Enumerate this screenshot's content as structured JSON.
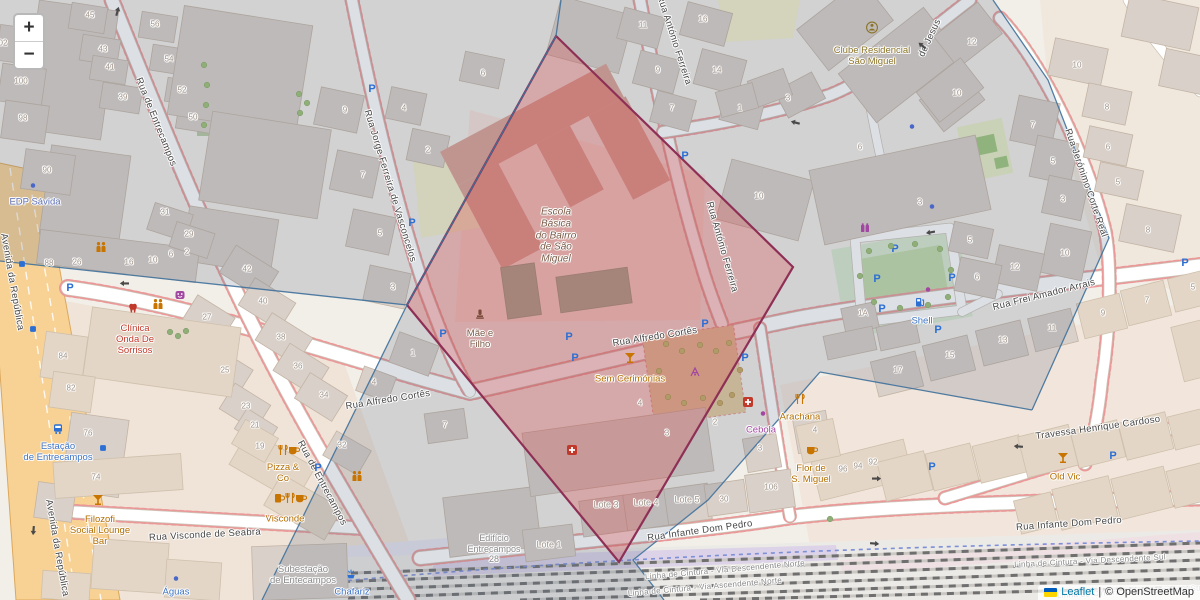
{
  "controls": {
    "zoom_in": "+",
    "zoom_out": "−"
  },
  "attribution": {
    "flag": "ukraine-flag",
    "leaflet": "Leaflet",
    "divider": "|",
    "osm": "© OpenStreetMap"
  },
  "palette": {
    "street_label": "#454545",
    "amenity": "#b36d00",
    "shop": "#a146a1",
    "transport": "#3d73c5",
    "office": "#5c6fb5",
    "health": "#c0392b",
    "school": "#7a5c49",
    "club": "#8a7326",
    "muted": "#8a8a8a",
    "housenumber": "#a09488",
    "rail_label": "#8c8c8c",
    "highlight_fill": "#dd4b4b",
    "highlight_stroke": "#8e2f55",
    "cell_lines": "#40719b"
  },
  "streets": [
    {
      "t": "Rua de Entrecampos",
      "x": 156,
      "y": 122,
      "rot": 68
    },
    {
      "t": "Rua de Entrecampos",
      "x": 322,
      "y": 483,
      "rot": 62
    },
    {
      "t": "Rua Jorge Ferreira de Vasconcelos",
      "x": 390,
      "y": 186,
      "rot": 73
    },
    {
      "t": "Rua António Ferreira",
      "x": 674,
      "y": 40,
      "rot": 72
    },
    {
      "t": "Rua António Ferreira",
      "x": 722,
      "y": 247,
      "rot": 74
    },
    {
      "t": "Rua Alfredo Cortês",
      "x": 388,
      "y": 400,
      "rot": -9
    },
    {
      "t": "Rua Alfredo Cortês",
      "x": 655,
      "y": 337,
      "rot": -9
    },
    {
      "t": "Rua Frei Amador Arrais",
      "x": 1044,
      "y": 295,
      "rot": -14
    },
    {
      "t": "Rua Jerónimo Corte Real",
      "x": 1086,
      "y": 183,
      "rot": 71
    },
    {
      "t": "Travessa Henrique Cardoso",
      "x": 1098,
      "y": 428,
      "rot": -8
    },
    {
      "t": "Rua Visconde de Seabra",
      "x": 205,
      "y": 535,
      "rot": -3
    },
    {
      "t": "Rua Infante Dom Pedro",
      "x": 700,
      "y": 531,
      "rot": -8
    },
    {
      "t": "Rua Infante Dom Pedro",
      "x": 1069,
      "y": 524,
      "rot": -4
    },
    {
      "t": "Avenida da República",
      "x": 12,
      "y": 282,
      "rot": 80
    },
    {
      "t": "Avenida da República",
      "x": 57,
      "y": 548,
      "rot": 80
    },
    {
      "t": "de Jesus",
      "x": 930,
      "y": 38,
      "rot": -65
    },
    {
      "t": "Linha de Cintura - Via Descendente Norte",
      "x": 725,
      "y": 570,
      "rot": -5,
      "sz": 8,
      "c": "rail_label"
    },
    {
      "t": "Linha de Cintura - Via Ascendente Norte",
      "x": 705,
      "y": 587,
      "rot": -5,
      "sz": 8,
      "c": "rail_label"
    },
    {
      "t": "Linha de Cintura - Via Descendente Sul",
      "x": 1090,
      "y": 561,
      "rot": -3,
      "sz": 8,
      "c": "rail_label"
    },
    {
      "t": "Linha de Cintura - Via Ascendente Sul",
      "x": 1130,
      "y": 592,
      "rot": -3,
      "sz": 8,
      "c": "rail_label"
    }
  ],
  "pois": [
    {
      "t": "EDP Sávida",
      "x": 35,
      "y": 202,
      "c": "office"
    },
    {
      "t": "Clínica\nOnda De\nSorrisos",
      "x": 135,
      "y": 340,
      "c": "health"
    },
    {
      "t": "Clube Residencial\nSão Miguel",
      "x": 872,
      "y": 56,
      "c": "club"
    },
    {
      "t": "Escola\nBásica\ndo Bairro\nde São\nMiguel",
      "x": 556,
      "y": 236,
      "c": "school",
      "it": 1,
      "sz": 10
    },
    {
      "t": "Mãe e\nFilho",
      "x": 480,
      "y": 339,
      "c": "school"
    },
    {
      "t": "Sem Cerimónias",
      "x": 630,
      "y": 379,
      "c": "amenity"
    },
    {
      "t": "Filozofi\nSocial Lounge\nBar",
      "x": 100,
      "y": 531,
      "c": "amenity"
    },
    {
      "t": "Pizza &\nCo",
      "x": 283,
      "y": 473,
      "c": "amenity"
    },
    {
      "t": "Visconde",
      "x": 285,
      "y": 519,
      "c": "amenity"
    },
    {
      "t": "Arachana",
      "x": 800,
      "y": 417,
      "c": "amenity"
    },
    {
      "t": "Cebola",
      "x": 761,
      "y": 430,
      "c": "shop"
    },
    {
      "t": "Flor de\nS. Miguel",
      "x": 811,
      "y": 474,
      "c": "amenity"
    },
    {
      "t": "Old Vic",
      "x": 1065,
      "y": 477,
      "c": "amenity"
    },
    {
      "t": "Shell",
      "x": 922,
      "y": 321,
      "c": "transport"
    },
    {
      "t": "Estação\nde Entrecampos",
      "x": 58,
      "y": 452,
      "c": "transport"
    },
    {
      "t": "Águas",
      "x": 176,
      "y": 592,
      "c": "transport"
    },
    {
      "t": "Chafariz",
      "x": 352,
      "y": 592,
      "c": "transport"
    },
    {
      "t": "Subestação\nde Entecampos",
      "x": 303,
      "y": 575,
      "c": "muted"
    },
    {
      "t": "Edifício\nEntrecampos\n28",
      "x": 494,
      "y": 549,
      "c": "muted",
      "sz": 9
    },
    {
      "t": "Lote 1",
      "x": 549,
      "y": 545,
      "c": "housenumber",
      "sz": 9
    },
    {
      "t": "Lote 3",
      "x": 606,
      "y": 505,
      "c": "housenumber",
      "sz": 9
    },
    {
      "t": "Lote 4",
      "x": 646,
      "y": 503,
      "c": "housenumber",
      "sz": 9
    },
    {
      "t": "Lote 5",
      "x": 687,
      "y": 500,
      "c": "housenumber",
      "sz": 9
    }
  ],
  "house_numbers": [
    {
      "t": "02",
      "x": 3,
      "y": 43
    },
    {
      "t": "100",
      "x": 21,
      "y": 81
    },
    {
      "t": "98",
      "x": 23,
      "y": 118
    },
    {
      "t": "90",
      "x": 47,
      "y": 170
    },
    {
      "t": "45",
      "x": 90,
      "y": 15
    },
    {
      "t": "43",
      "x": 103,
      "y": 49
    },
    {
      "t": "41",
      "x": 110,
      "y": 67
    },
    {
      "t": "39",
      "x": 123,
      "y": 97
    },
    {
      "t": "56",
      "x": 155,
      "y": 24
    },
    {
      "t": "54",
      "x": 169,
      "y": 59
    },
    {
      "t": "52",
      "x": 182,
      "y": 90
    },
    {
      "t": "50",
      "x": 193,
      "y": 117
    },
    {
      "t": "88",
      "x": 49,
      "y": 263
    },
    {
      "t": "26",
      "x": 77,
      "y": 262
    },
    {
      "t": "16",
      "x": 129,
      "y": 262
    },
    {
      "t": "10",
      "x": 153,
      "y": 260
    },
    {
      "t": "6",
      "x": 171,
      "y": 254
    },
    {
      "t": "2",
      "x": 187,
      "y": 252
    },
    {
      "t": "31",
      "x": 165,
      "y": 212
    },
    {
      "t": "29",
      "x": 189,
      "y": 234
    },
    {
      "t": "27",
      "x": 207,
      "y": 317
    },
    {
      "t": "25",
      "x": 225,
      "y": 370
    },
    {
      "t": "23",
      "x": 246,
      "y": 406
    },
    {
      "t": "21",
      "x": 255,
      "y": 425
    },
    {
      "t": "42",
      "x": 247,
      "y": 269
    },
    {
      "t": "40",
      "x": 263,
      "y": 301
    },
    {
      "t": "38",
      "x": 281,
      "y": 337
    },
    {
      "t": "36",
      "x": 298,
      "y": 366
    },
    {
      "t": "34",
      "x": 324,
      "y": 395
    },
    {
      "t": "84",
      "x": 63,
      "y": 356
    },
    {
      "t": "82",
      "x": 71,
      "y": 388
    },
    {
      "t": "76",
      "x": 88,
      "y": 433
    },
    {
      "t": "74",
      "x": 96,
      "y": 477
    },
    {
      "t": "19",
      "x": 260,
      "y": 446
    },
    {
      "t": "32",
      "x": 342,
      "y": 445
    },
    {
      "t": "9",
      "x": 345,
      "y": 110
    },
    {
      "t": "7",
      "x": 363,
      "y": 175
    },
    {
      "t": "5",
      "x": 380,
      "y": 233
    },
    {
      "t": "3",
      "x": 393,
      "y": 287
    },
    {
      "t": "4",
      "x": 404,
      "y": 108
    },
    {
      "t": "2",
      "x": 428,
      "y": 150
    },
    {
      "t": "6",
      "x": 483,
      "y": 73
    },
    {
      "t": "1",
      "x": 413,
      "y": 353
    },
    {
      "t": "4",
      "x": 374,
      "y": 382
    },
    {
      "t": "7",
      "x": 445,
      "y": 425
    },
    {
      "t": "11",
      "x": 643,
      "y": 25
    },
    {
      "t": "9",
      "x": 658,
      "y": 70
    },
    {
      "t": "7",
      "x": 672,
      "y": 108
    },
    {
      "t": "16",
      "x": 703,
      "y": 19
    },
    {
      "t": "14",
      "x": 717,
      "y": 70
    },
    {
      "t": "1",
      "x": 740,
      "y": 108
    },
    {
      "t": "10",
      "x": 759,
      "y": 196
    },
    {
      "t": "3",
      "x": 788,
      "y": 98
    },
    {
      "t": "6",
      "x": 860,
      "y": 147
    },
    {
      "t": "12",
      "x": 972,
      "y": 42
    },
    {
      "t": "10",
      "x": 957,
      "y": 93
    },
    {
      "t": "3",
      "x": 920,
      "y": 202
    },
    {
      "t": "5",
      "x": 970,
      "y": 240
    },
    {
      "t": "6",
      "x": 977,
      "y": 277
    },
    {
      "t": "12",
      "x": 1015,
      "y": 267
    },
    {
      "t": "10",
      "x": 1065,
      "y": 253
    },
    {
      "t": "1A",
      "x": 863,
      "y": 313
    },
    {
      "t": "7",
      "x": 1033,
      "y": 125
    },
    {
      "t": "5",
      "x": 1053,
      "y": 161
    },
    {
      "t": "3",
      "x": 1063,
      "y": 199
    },
    {
      "t": "10",
      "x": 1077,
      "y": 65
    },
    {
      "t": "8",
      "x": 1107,
      "y": 107
    },
    {
      "t": "6",
      "x": 1108,
      "y": 147
    },
    {
      "t": "5",
      "x": 1118,
      "y": 182
    },
    {
      "t": "8",
      "x": 1148,
      "y": 230
    },
    {
      "t": "17",
      "x": 898,
      "y": 370
    },
    {
      "t": "15",
      "x": 950,
      "y": 355
    },
    {
      "t": "13",
      "x": 1003,
      "y": 340
    },
    {
      "t": "11",
      "x": 1052,
      "y": 328
    },
    {
      "t": "9",
      "x": 1103,
      "y": 313
    },
    {
      "t": "7",
      "x": 1147,
      "y": 300
    },
    {
      "t": "5",
      "x": 1193,
      "y": 287
    },
    {
      "t": "96",
      "x": 843,
      "y": 469
    },
    {
      "t": "94",
      "x": 858,
      "y": 466
    },
    {
      "t": "92",
      "x": 873,
      "y": 462
    },
    {
      "t": "106",
      "x": 771,
      "y": 487
    },
    {
      "t": "30",
      "x": 724,
      "y": 499
    },
    {
      "t": "4",
      "x": 815,
      "y": 430
    },
    {
      "t": "3",
      "x": 760,
      "y": 448
    },
    {
      "t": "2",
      "x": 715,
      "y": 422
    },
    {
      "t": "3",
      "x": 667,
      "y": 433
    },
    {
      "t": "4",
      "x": 640,
      "y": 403
    }
  ],
  "icons": [
    {
      "k": "parking",
      "x": 70,
      "y": 287
    },
    {
      "k": "parking",
      "x": 318,
      "y": 467
    },
    {
      "k": "parking",
      "x": 372,
      "y": 88
    },
    {
      "k": "parking",
      "x": 412,
      "y": 222
    },
    {
      "k": "parking",
      "x": 443,
      "y": 333
    },
    {
      "k": "parking",
      "x": 569,
      "y": 336
    },
    {
      "k": "parking",
      "x": 575,
      "y": 357
    },
    {
      "k": "parking",
      "x": 685,
      "y": 155
    },
    {
      "k": "parking",
      "x": 705,
      "y": 323
    },
    {
      "k": "parking",
      "x": 745,
      "y": 357
    },
    {
      "k": "parking",
      "x": 895,
      "y": 248
    },
    {
      "k": "parking",
      "x": 877,
      "y": 278
    },
    {
      "k": "parking",
      "x": 952,
      "y": 277
    },
    {
      "k": "parking",
      "x": 882,
      "y": 308
    },
    {
      "k": "parking",
      "x": 938,
      "y": 329
    },
    {
      "k": "parking",
      "x": 932,
      "y": 466
    },
    {
      "k": "parking",
      "x": 1113,
      "y": 455
    },
    {
      "k": "parking",
      "x": 1185,
      "y": 262
    },
    {
      "k": "busstop",
      "x": 22,
      "y": 265
    },
    {
      "k": "busstop",
      "x": 33,
      "y": 330
    },
    {
      "k": "busstop",
      "x": 103,
      "y": 449
    },
    {
      "k": "dot-blue",
      "x": 33,
      "y": 186
    },
    {
      "k": "dot-blue",
      "x": 912,
      "y": 127
    },
    {
      "k": "dot-blue",
      "x": 932,
      "y": 207
    },
    {
      "k": "dot-blue",
      "x": 176,
      "y": 579
    },
    {
      "k": "dot-purple",
      "x": 763,
      "y": 414
    },
    {
      "k": "dot-purple",
      "x": 928,
      "y": 290
    },
    {
      "k": "charging-station",
      "x": 865,
      "y": 230
    },
    {
      "k": "theatre-mask",
      "x": 180,
      "y": 297
    },
    {
      "k": "tooth",
      "x": 133,
      "y": 310
    },
    {
      "k": "first-aid",
      "x": 748,
      "y": 404
    },
    {
      "k": "first-aid",
      "x": 572,
      "y": 452
    },
    {
      "k": "people",
      "x": 101,
      "y": 249
    },
    {
      "k": "people",
      "x": 158,
      "y": 306
    },
    {
      "k": "people",
      "x": 357,
      "y": 478
    },
    {
      "k": "cocktail",
      "x": 98,
      "y": 502
    },
    {
      "k": "cocktail",
      "x": 630,
      "y": 360
    },
    {
      "k": "cocktail",
      "x": 1063,
      "y": 460
    },
    {
      "k": "beer",
      "x": 279,
      "y": 500
    },
    {
      "k": "cutlery",
      "x": 290,
      "y": 500
    },
    {
      "k": "cup",
      "x": 301,
      "y": 500
    },
    {
      "k": "cutlery",
      "x": 283,
      "y": 452
    },
    {
      "k": "cup",
      "x": 294,
      "y": 452
    },
    {
      "k": "cutlery",
      "x": 800,
      "y": 401
    },
    {
      "k": "cup",
      "x": 812,
      "y": 452
    },
    {
      "k": "fuel",
      "x": 920,
      "y": 304
    },
    {
      "k": "train-station",
      "x": 58,
      "y": 431
    },
    {
      "k": "fountain",
      "x": 351,
      "y": 576
    },
    {
      "k": "statue",
      "x": 480,
      "y": 316
    },
    {
      "k": "club-person",
      "x": 872,
      "y": 30
    },
    {
      "k": "playground",
      "x": 695,
      "y": 374
    },
    {
      "k": "arrow",
      "x": 118,
      "y": 12,
      "r": -75
    },
    {
      "k": "arrow",
      "x": 124,
      "y": 284,
      "r": 180
    },
    {
      "k": "arrow",
      "x": 795,
      "y": 123,
      "r": 195
    },
    {
      "k": "arrow",
      "x": 930,
      "y": 233,
      "r": 170
    },
    {
      "k": "arrow",
      "x": 1018,
      "y": 447,
      "r": 185
    },
    {
      "k": "arrow",
      "x": 877,
      "y": 480,
      "r": 0
    },
    {
      "k": "arrow",
      "x": 875,
      "y": 545,
      "r": 5
    },
    {
      "k": "arrow",
      "x": 33,
      "y": 532,
      "r": 95
    },
    {
      "k": "arrow",
      "x": 922,
      "y": 46,
      "r": 220
    },
    {
      "k": "tree",
      "x": 204,
      "y": 66
    },
    {
      "k": "tree",
      "x": 207,
      "y": 86
    },
    {
      "k": "tree",
      "x": 206,
      "y": 106
    },
    {
      "k": "tree",
      "x": 204,
      "y": 126
    },
    {
      "k": "tree",
      "x": 299,
      "y": 95
    },
    {
      "k": "tree",
      "x": 307,
      "y": 104
    },
    {
      "k": "tree",
      "x": 300,
      "y": 114
    },
    {
      "k": "tree",
      "x": 869,
      "y": 252
    },
    {
      "k": "tree",
      "x": 891,
      "y": 247
    },
    {
      "k": "tree",
      "x": 915,
      "y": 245
    },
    {
      "k": "tree",
      "x": 940,
      "y": 250
    },
    {
      "k": "tree",
      "x": 874,
      "y": 303
    },
    {
      "k": "tree",
      "x": 900,
      "y": 309
    },
    {
      "k": "tree",
      "x": 928,
      "y": 306
    },
    {
      "k": "tree",
      "x": 948,
      "y": 298
    },
    {
      "k": "tree",
      "x": 860,
      "y": 277
    },
    {
      "k": "tree",
      "x": 951,
      "y": 271
    },
    {
      "k": "tree",
      "x": 170,
      "y": 333
    },
    {
      "k": "tree",
      "x": 178,
      "y": 337
    },
    {
      "k": "tree",
      "x": 186,
      "y": 332
    },
    {
      "k": "tree",
      "x": 830,
      "y": 520
    },
    {
      "k": "tree-dry",
      "x": 666,
      "y": 345
    },
    {
      "k": "tree-dry",
      "x": 682,
      "y": 352
    },
    {
      "k": "tree-dry",
      "x": 700,
      "y": 346
    },
    {
      "k": "tree-dry",
      "x": 716,
      "y": 352
    },
    {
      "k": "tree-dry",
      "x": 729,
      "y": 344
    },
    {
      "k": "tree-dry",
      "x": 668,
      "y": 398
    },
    {
      "k": "tree-dry",
      "x": 684,
      "y": 404
    },
    {
      "k": "tree-dry",
      "x": 703,
      "y": 399
    },
    {
      "k": "tree-dry",
      "x": 720,
      "y": 404
    },
    {
      "k": "tree-dry",
      "x": 732,
      "y": 396
    },
    {
      "k": "tree-dry",
      "x": 659,
      "y": 372
    },
    {
      "k": "tree-dry",
      "x": 740,
      "y": 371
    }
  ],
  "overlay_geometry_note": "red highlight polygon over Escola Básica do Bairro de São Miguel; blue cell boundary lines"
}
